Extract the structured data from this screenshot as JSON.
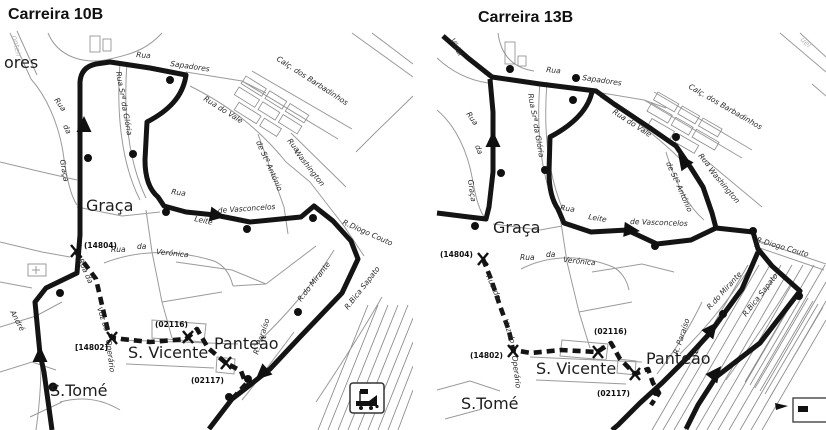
{
  "left": {
    "title": "Carreira 10B",
    "areas": {
      "edge": "ores",
      "graca": "Graça",
      "svicente": "S. Vicente",
      "panteao": "Panteão",
      "stome": "S.Tomé"
    },
    "stops": {
      "s14804": "(14804)",
      "s14802": "[14802]",
      "s02116": "(02116)",
      "s02117": "(02117)"
    },
    "streets": {
      "rua_a": "Rua",
      "sapadores": "Sapadores",
      "barbadinhos": "Calç. dos Barbadinhos",
      "vale": "Rua do Vale",
      "st_antonio": "de Stº António",
      "rua_b": "Rua",
      "washington": "Washington",
      "rua_c": "Rua",
      "leite": "Leite",
      "vasconcelos": "de Vasconcelos",
      "gloria": "Rua Srª da Glória",
      "rua_d": "Rua",
      "da_a": "da",
      "graca_st": "Graça",
      "rua_e": "Rua",
      "da_b": "da",
      "veronica": "Verónica",
      "voz_a": "Rua da",
      "voz_b": "Voz do",
      "operario": "Operário",
      "andre": "André",
      "mirante": "R.do Mirante",
      "paraiso": "R. Paraíso",
      "bica": "R.Bica Sapato",
      "diogo": "R.Diogo Couto",
      "monteiro": "onteir"
    }
  },
  "right": {
    "title": "Carreira 13B",
    "areas": {
      "graca": "Graça",
      "svicente": "S. Vicente",
      "panteao": "Panteão",
      "stome": "S.Tomé"
    },
    "stops": {
      "s14804": "(14804)",
      "s14802": "(14802)",
      "s02116": "(02116)",
      "s02117": "(02117)"
    },
    "streets": {
      "vidal": "Vidal",
      "rua_a": "Rua",
      "sapadores": "Sapadores",
      "barbadinhos": "Calç. dos Barbadinhos",
      "vale": "Rua do Vale",
      "st_antonio": "de Stº António",
      "rua_b": "Rua",
      "washington": "Washington",
      "rua_c": "Rua",
      "leite": "Leite",
      "vasconcelos": "de Vasconcelos",
      "gloria": "Rua Srª da Glória",
      "rua_d": "Rua",
      "da_a": "da",
      "graca_st": "Graça",
      "rua_e": "Rua",
      "da_b": "da",
      "veronica": "Verónica",
      "voz_a": "Rua da",
      "voz_b": "Voz do",
      "operario": "Operário",
      "mirante": "R.do Mirante",
      "paraiso": "R. Paraíso",
      "bica": "R.Bica Sapato",
      "diogo": "R.Diogo Couto",
      "uel": "uel"
    }
  },
  "icons": {
    "tram": "tram-icon"
  },
  "colors": {
    "route": "#141414",
    "street": "#9b9b9b",
    "text": "#222222",
    "background": "#ffffff"
  }
}
